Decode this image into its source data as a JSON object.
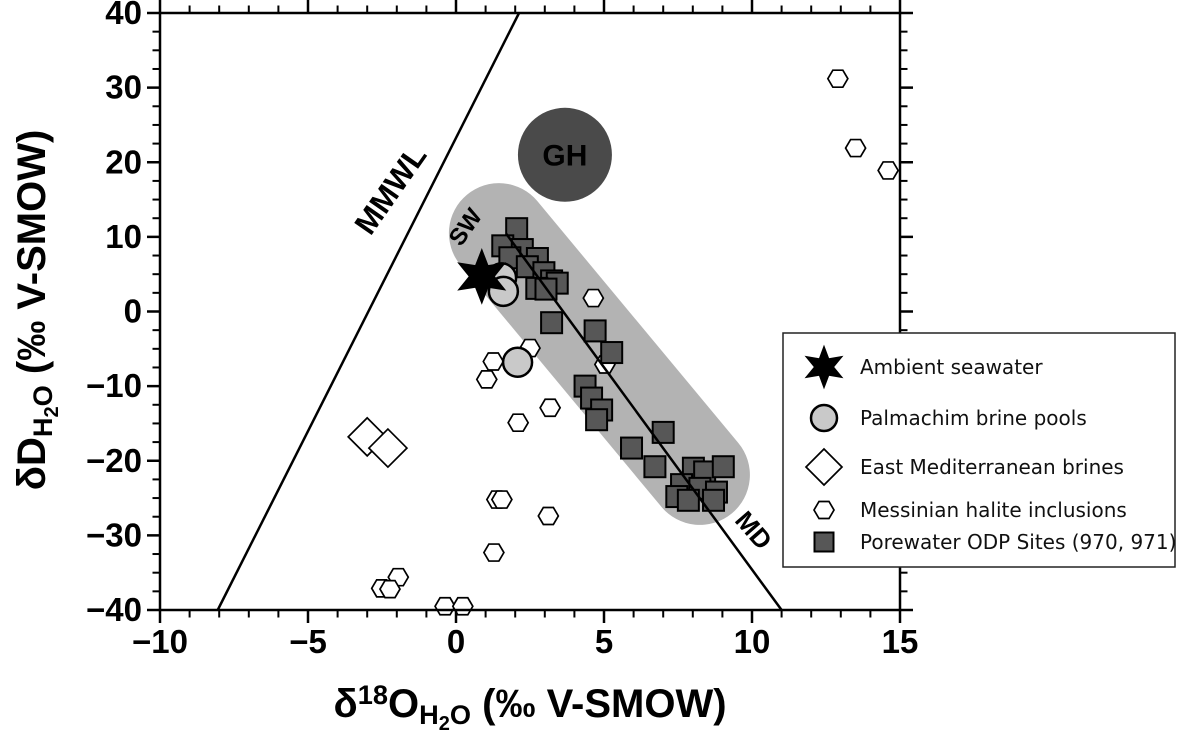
{
  "figure": {
    "width": 1181,
    "height": 738,
    "background": "#ffffff"
  },
  "colors": {
    "frame": "#000000",
    "dark_marker": "#575757",
    "light_circle": "#c9c9c9",
    "capsule": "#b3b3b3",
    "gh_fill": "#4a4a4a",
    "white": "#ffffff",
    "text": "#000000"
  },
  "chart_data": {
    "type": "scatter",
    "xlabel_parts": [
      {
        "t": "δ"
      },
      {
        "t": "18",
        "style": "sup"
      },
      {
        "t": "O"
      },
      {
        "t": "H",
        "style": "sub"
      },
      {
        "t": "2",
        "style": "subsub"
      },
      {
        "t": "O",
        "style": "sub"
      },
      {
        "t": " (‰ V-SMOW)"
      }
    ],
    "ylabel_parts": [
      {
        "t": "δD"
      },
      {
        "t": "H",
        "style": "sub"
      },
      {
        "t": "2",
        "style": "subsub"
      },
      {
        "t": "O",
        "style": "sub"
      },
      {
        "t": " (‰ V-SMOW)"
      }
    ],
    "xlim": [
      -10,
      15
    ],
    "ylim": [
      -40,
      40
    ],
    "x_major_ticks": [
      -10,
      -5,
      0,
      5,
      10,
      15
    ],
    "x_tick_labels": [
      "−10",
      "−5",
      "0",
      "5",
      "10",
      "15"
    ],
    "x_minor_step": 1,
    "y_major_ticks": [
      -40,
      -30,
      -20,
      -10,
      0,
      10,
      20,
      30,
      40
    ],
    "y_tick_labels": [
      "−40",
      "−30",
      "−20",
      "−10",
      "0",
      "10",
      "20",
      "30",
      "40"
    ],
    "y_minor_step": 2.5,
    "grid": false,
    "legend_position": "right",
    "series": [
      {
        "name": "Ambient seawater",
        "marker": "star6",
        "fill": "#000000",
        "stroke": "#000000",
        "z": 9,
        "points": [
          [
            0.87,
            4.7
          ]
        ]
      },
      {
        "name": "Palmachim brine pools",
        "marker": "circle",
        "fill": "#c9c9c9",
        "stroke": "#000000",
        "z": 8,
        "points": [
          [
            1.54,
            4.5
          ],
          [
            1.6,
            2.7
          ],
          [
            2.08,
            -6.8
          ]
        ]
      },
      {
        "name": "East Mediterranean brines",
        "marker": "diamond",
        "fill": "#ffffff",
        "stroke": "#000000",
        "z": 3,
        "points": [
          [
            -3.0,
            -16.8
          ],
          [
            -2.3,
            -18.3
          ]
        ]
      },
      {
        "name": "Messinian halite inclusions",
        "marker": "hexagon",
        "fill": "#ffffff",
        "stroke": "#000000",
        "z": 4,
        "points": [
          [
            12.9,
            31.2
          ],
          [
            13.5,
            21.9
          ],
          [
            14.6,
            18.9
          ],
          [
            4.64,
            1.8
          ],
          [
            2.5,
            -4.9
          ],
          [
            1.26,
            -6.7
          ],
          [
            1.04,
            -9.1
          ],
          [
            5.03,
            -7.1
          ],
          [
            3.18,
            -12.9
          ],
          [
            2.1,
            -14.9
          ],
          [
            1.38,
            -25.2
          ],
          [
            1.55,
            -25.2
          ],
          [
            3.12,
            -27.4
          ],
          [
            1.28,
            -32.3
          ],
          [
            -1.95,
            -35.6
          ],
          [
            -2.51,
            -37.1
          ],
          [
            -2.23,
            -37.2
          ],
          [
            -0.37,
            -39.5
          ],
          [
            0.23,
            -39.5
          ]
        ]
      },
      {
        "name": "Porewater ODP Sites (970, 971)",
        "marker": "square",
        "fill": "#575757",
        "stroke": "#000000",
        "z": 5,
        "points": [
          [
            2.05,
            11.1
          ],
          [
            1.58,
            8.8
          ],
          [
            2.24,
            8.3
          ],
          [
            1.82,
            7.2
          ],
          [
            2.75,
            7.1
          ],
          [
            2.41,
            6.0
          ],
          [
            2.97,
            5.2
          ],
          [
            3.23,
            4.1
          ],
          [
            3.42,
            3.8
          ],
          [
            2.73,
            3.1
          ],
          [
            3.04,
            3.0
          ],
          [
            3.23,
            -1.5
          ],
          [
            4.7,
            -2.6
          ],
          [
            5.26,
            -5.5
          ],
          [
            4.36,
            -10.0
          ],
          [
            4.58,
            -11.6
          ],
          [
            4.92,
            -13.2
          ],
          [
            4.75,
            -14.5
          ],
          [
            7.0,
            -16.2
          ],
          [
            5.93,
            -18.3
          ],
          [
            6.72,
            -20.8
          ],
          [
            8.02,
            -21.0
          ],
          [
            8.4,
            -21.5
          ],
          [
            9.03,
            -20.8
          ],
          [
            7.62,
            -23.2
          ],
          [
            8.24,
            -23.7
          ],
          [
            8.8,
            -24.2
          ],
          [
            7.46,
            -24.8
          ],
          [
            7.85,
            -25.3
          ],
          [
            8.7,
            -25.3
          ]
        ]
      }
    ],
    "lines": [
      {
        "name": "MMWL",
        "x1": -8.05,
        "y1": -40,
        "x2": 2.13,
        "y2": 40,
        "z": 2
      },
      {
        "name": "MD",
        "x1": 1.7,
        "y1": 10.4,
        "x2": 11.0,
        "y2": -40,
        "z": 6
      }
    ],
    "annotations": [
      {
        "text": "MMWL",
        "x": -1.92,
        "y": 15.5,
        "rotation": -55,
        "size": 31
      },
      {
        "text": "SW",
        "x": 0.54,
        "y": 10.7,
        "rotation": -55,
        "size": 24
      },
      {
        "text": "MD",
        "x": 9.83,
        "y": -30.1,
        "rotation": 49,
        "size": 26
      }
    ],
    "shapes": {
      "gh_circle": {
        "label": "GH",
        "cx": 3.68,
        "cy": 21.0,
        "r_px": 47,
        "fill": "#4a4a4a",
        "label_color": "#ffffff",
        "label_size": 30
      },
      "capsule": {
        "x1": 1.45,
        "y1": 10.5,
        "x2": 8.24,
        "y2": -21.9,
        "half_width_px": 50,
        "fill": "#b3b3b3"
      }
    }
  },
  "legend": {
    "items": [
      {
        "label": "Ambient seawater",
        "marker": "star6",
        "fill": "#000000"
      },
      {
        "label": "Palmachim brine pools",
        "marker": "circle",
        "fill": "#c9c9c9"
      },
      {
        "label": "East Mediterranean brines",
        "marker": "diamond",
        "fill": "#ffffff"
      },
      {
        "label": "Messinian halite inclusions",
        "marker": "hexagon",
        "fill": "#ffffff"
      },
      {
        "label": "Porewater ODP Sites (970, 971)",
        "marker": "square",
        "fill": "#575757"
      }
    ]
  }
}
